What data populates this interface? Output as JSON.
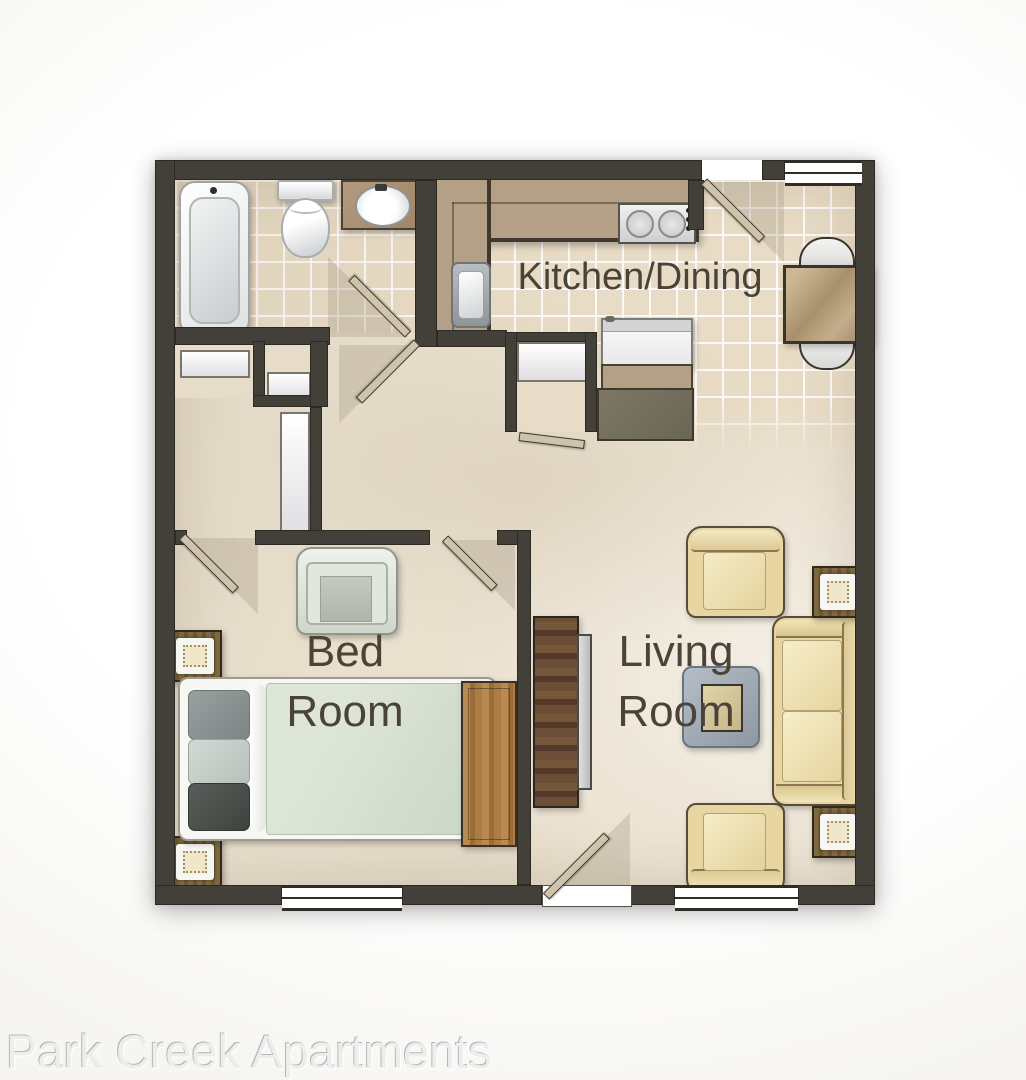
{
  "rooms": {
    "kitchen_dining": {
      "label": "Kitchen/Dining"
    },
    "bedroom": {
      "line1": "Bed",
      "line2": "Room"
    },
    "living_room": {
      "line1": "Living",
      "line2": "Room"
    }
  },
  "footer": {
    "brand": "Park Creek Apartments"
  },
  "palette": {
    "wall": "#43403a",
    "floor": "#eae1cf",
    "tile": "#e9dcc6",
    "grout": "#ffffff",
    "counter": "#b3a086",
    "cream_upholstery": "#eddfb0",
    "sage_mattress": "#d7e0d2",
    "wood_dark": "#5d4731",
    "wood_light": "#b0803f",
    "label_text": "#4b4238",
    "watermark_text": "#ededeb"
  },
  "furniture_icons": [
    "bathtub",
    "toilet",
    "vanity-sink",
    "kitchen-counter",
    "cooktop",
    "kitchen-sink",
    "refrigerator",
    "kitchen-cabinet",
    "dining-table",
    "dining-chair",
    "closet-door",
    "bed",
    "pillows",
    "nightstand-lamp",
    "dresser",
    "chest-of-drawers",
    "tv-console",
    "armchair",
    "sofa",
    "end-table-lamp",
    "coffee-table"
  ]
}
